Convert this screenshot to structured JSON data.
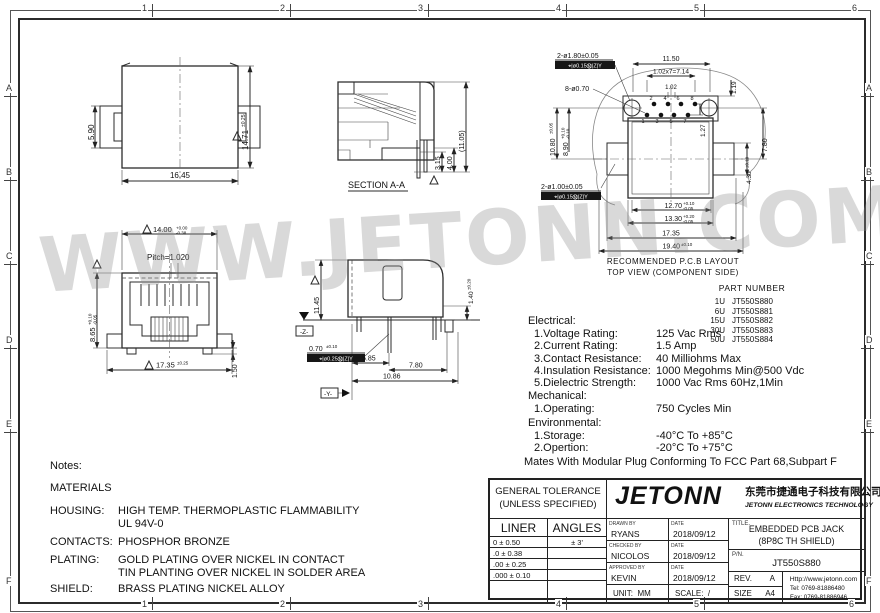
{
  "frame": {
    "cols": [
      "1",
      "2",
      "3",
      "4",
      "5",
      "6"
    ],
    "rows": [
      "A",
      "B",
      "C",
      "D",
      "E",
      "F"
    ]
  },
  "watermark": "WWW.JETONN.COM",
  "views": {
    "front": {
      "w": "16.45",
      "tab": "5.90",
      "h": "14.71",
      "h_tol": "±0.25"
    },
    "section": {
      "label": "SECTION A-A",
      "d1": "3.15",
      "d2": "4.00",
      "d3": "(11.05)"
    },
    "pcb": {
      "caption1": "RECOMMENDED P.C.B LAYOUT",
      "caption2": "TOP VIEW (COMPONENT SIDE)",
      "big_holes": "2-ø1.80±0.05",
      "fcf_big": "⌖|ø0.15Ⓜ|Z|Y",
      "small_holes": "8-ø0.70",
      "mid_holes": "2-ø1.00±0.05",
      "fcf_mid": "⌖|ø0.15Ⓜ|Z|Y",
      "d_1150": "11.50",
      "d_row": "1.02x7=7.14",
      "d_119": "1.19",
      "d_102": "1.02",
      "d_127": "1.27",
      "d_780": "7.80",
      "d_1080": "10.80",
      "t_1080": "±0.05",
      "d_890": "8.90",
      "t_890_sup": "+0.10",
      "t_890_sub": "-0.10",
      "d_430": "4.30",
      "t_430": "±0.10",
      "d_1270": "12.70",
      "t_1270_sup": "+0.10",
      "t_1270_sub": "-0.05",
      "d_1330": "13.30",
      "t_1330_sup": "+0.20",
      "t_1330_sub": "-0.05",
      "d_1735": "17.35",
      "d_1940": "19.40",
      "t_1940": "±0.10",
      "pins": [
        "1",
        "2",
        "3",
        "4",
        "5",
        "6",
        "7",
        "8"
      ]
    },
    "jack": {
      "d_1400": "14.00",
      "t_1400_sup": "+0.00",
      "t_1400_sub": "-0.38",
      "pitch": "Pitch=1.020",
      "d_865": "8.65",
      "t_865_sup": "+0.10",
      "t_865_sub": "-0.05",
      "d_150": "1.50",
      "d_1735": "17.35",
      "t_1735": "±0.25"
    },
    "side": {
      "d_1145": "11.45",
      "d_140": "1.40",
      "t_140": "±0.20",
      "d_070": "0.70",
      "t_070": "±0.10",
      "fcf": "⌖|ø0.25Ⓜ|Z|Y",
      "d_585": "5.85",
      "d_780": "7.80",
      "d_1086": "10.86",
      "datum_z": "-Z-",
      "datum_y": "-Y-"
    }
  },
  "part_table": {
    "header": "PART NUMBER",
    "rows": [
      [
        "1U",
        "JT550S880"
      ],
      [
        "6U",
        "JT550S881"
      ],
      [
        "15U",
        "JT550S882"
      ],
      [
        "30U",
        "JT550S883"
      ],
      [
        "50U",
        "JT550S884"
      ]
    ]
  },
  "specs": {
    "electrical_header": "Electrical:",
    "electrical": [
      {
        "name": "1.Voltage Rating:",
        "value": "125 Vac Rms"
      },
      {
        "name": "2.Current Rating:",
        "value": "1.5 Amp"
      },
      {
        "name": "3.Contact Resistance:",
        "value": "40 Milliohms Max"
      },
      {
        "name": "4.Insulation Resistance:",
        "value": "1000 Megohms Min@500 Vdc"
      },
      {
        "name": "5.Dielectric Strength:",
        "value": "1000 Vac Rms 60Hz,1Min"
      }
    ],
    "mechanical_header": "Mechanical:",
    "mechanical": [
      {
        "name": "1.Operating:",
        "value": "750 Cycles Min"
      }
    ],
    "environmental_header": "Environmental:",
    "environmental": [
      {
        "name": "1.Storage:",
        "value": "-40°C To +85°C"
      },
      {
        "name": "2.Opertion:",
        "value": "-20°C To +75°C"
      }
    ],
    "footer": "Mates With Modular Plug Conforming To FCC Part 68,Subpart F"
  },
  "notes": {
    "title": "Notes:",
    "materials_header": "MATERIALS",
    "rows": [
      {
        "label": "HOUSING:",
        "line1": "HIGH TEMP. THERMOPLASTIC FLAMMABILITY",
        "line2": "UL 94V-0"
      },
      {
        "label": "CONTACTS:",
        "line1": "PHOSPHOR BRONZE"
      },
      {
        "label": "PLATING:",
        "line1": "GOLD PLATING OVER NICKEL IN CONTACT",
        "line2": "TIN PLANTING OVER NICKEL IN SOLDER AREA"
      },
      {
        "label": "SHIELD:",
        "line1": "BRASS PLATING NICKEL ALLOY"
      }
    ]
  },
  "title_block": {
    "tolerance_header1": "GENERAL TOLERANCE",
    "tolerance_header2": "(UNLESS SPECIFIED)",
    "liner_header": "LINER",
    "angles_header": "ANGLES",
    "tolerance_rows": [
      {
        "liner": "0    ±    0.50",
        "angles": "± 3'"
      },
      {
        "liner": ".0    ±    0.38",
        "angles": ""
      },
      {
        "liner": ".00   ±    0.25",
        "angles": ""
      },
      {
        "liner": ".000  ±    0.10",
        "angles": ""
      }
    ],
    "logo_text": "JETONN",
    "company_cn": "东莞市捷通电子科技有限公司",
    "company_en": "JETONN ELECTRONICS TECHNOLOGY",
    "drawn_label": "DRAWN BY",
    "drawn_name": "RYANS",
    "drawn_date_label": "DATE",
    "drawn_date": "2018/09/12",
    "checked_label": "CHECKED BY",
    "checked_name": "NICOLOS",
    "checked_date_label": "DATE",
    "checked_date": "2018/09/12",
    "approved_label": "APPROVED BY",
    "approved_name": "KEVIN",
    "approved_date_label": "DATE",
    "approved_date": "2018/09/12",
    "title_label": "TITLE.",
    "title_line1": "EMBEDDED PCB JACK",
    "title_line2": "(8P8C TH SHIELD)",
    "pn_label": "P/N.",
    "pn_value": "JT550S880",
    "rev_label": "REV.",
    "rev_value": "A",
    "size_label": "SIZE",
    "size_value": "A4",
    "website": "Http://www.jetonn.com",
    "tel": "Tel:  0769-81886480",
    "fax": "Fax: 0769-81886946",
    "unit_label": "UNIT:",
    "unit_value": "MM",
    "scale_label": "SCALE:",
    "scale_value": "/"
  }
}
